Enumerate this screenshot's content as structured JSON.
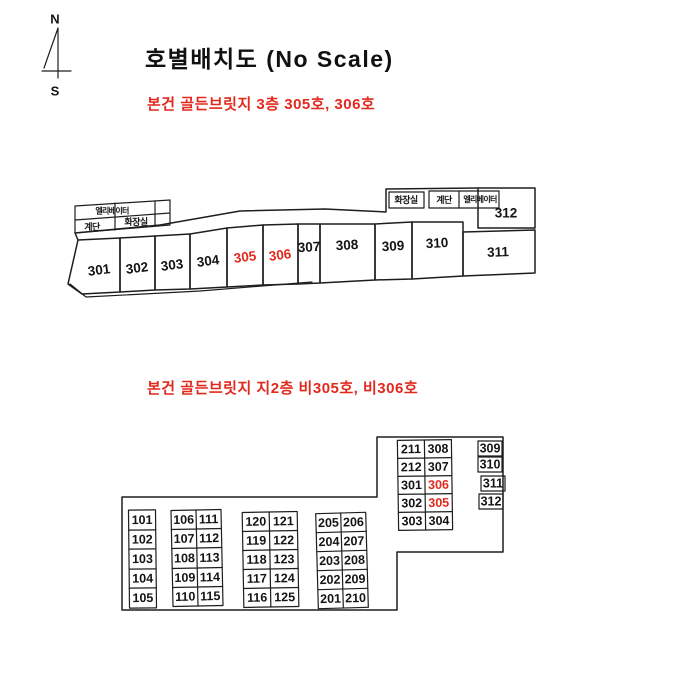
{
  "page": {
    "title": "호별배치도 (No Scale)",
    "background": "#ffffff",
    "ink_color": "#1e1e1e",
    "highlight_color": "#e2291d"
  },
  "compass": {
    "north": "N",
    "south": "S"
  },
  "floor3": {
    "subtitle": "본건 골든브릿지 3층 305호, 306호",
    "facilities": {
      "elevator": "엘리베이터",
      "stairs": "계단",
      "restroom": "화장실"
    },
    "units": [
      "301",
      "302",
      "303",
      "304",
      "305",
      "306",
      "307",
      "308",
      "309",
      "310",
      "311",
      "312"
    ],
    "highlighted_units": [
      "305",
      "306"
    ]
  },
  "floor_b2": {
    "subtitle": "본건 골든브릿지 지2층 비305호, 비306호",
    "highlighted_units": [
      "305",
      "306"
    ],
    "column_a": [
      "101",
      "102",
      "103",
      "104",
      "105"
    ],
    "grid_b": [
      [
        "106",
        "111"
      ],
      [
        "107",
        "112"
      ],
      [
        "108",
        "113"
      ],
      [
        "109",
        "114"
      ],
      [
        "110",
        "115"
      ]
    ],
    "grid_c": [
      [
        "120",
        "121"
      ],
      [
        "119",
        "122"
      ],
      [
        "118",
        "123"
      ],
      [
        "117",
        "124"
      ],
      [
        "116",
        "125"
      ]
    ],
    "grid_d": [
      [
        "205",
        "206"
      ],
      [
        "204",
        "207"
      ],
      [
        "203",
        "208"
      ],
      [
        "202",
        "209"
      ],
      [
        "201",
        "210"
      ]
    ],
    "grid_e": [
      [
        "211",
        "308"
      ],
      [
        "212",
        "307"
      ],
      [
        "301",
        "306"
      ],
      [
        "302",
        "305"
      ],
      [
        "303",
        "304"
      ]
    ],
    "column_f": [
      "309",
      "310",
      "311",
      "312"
    ]
  }
}
